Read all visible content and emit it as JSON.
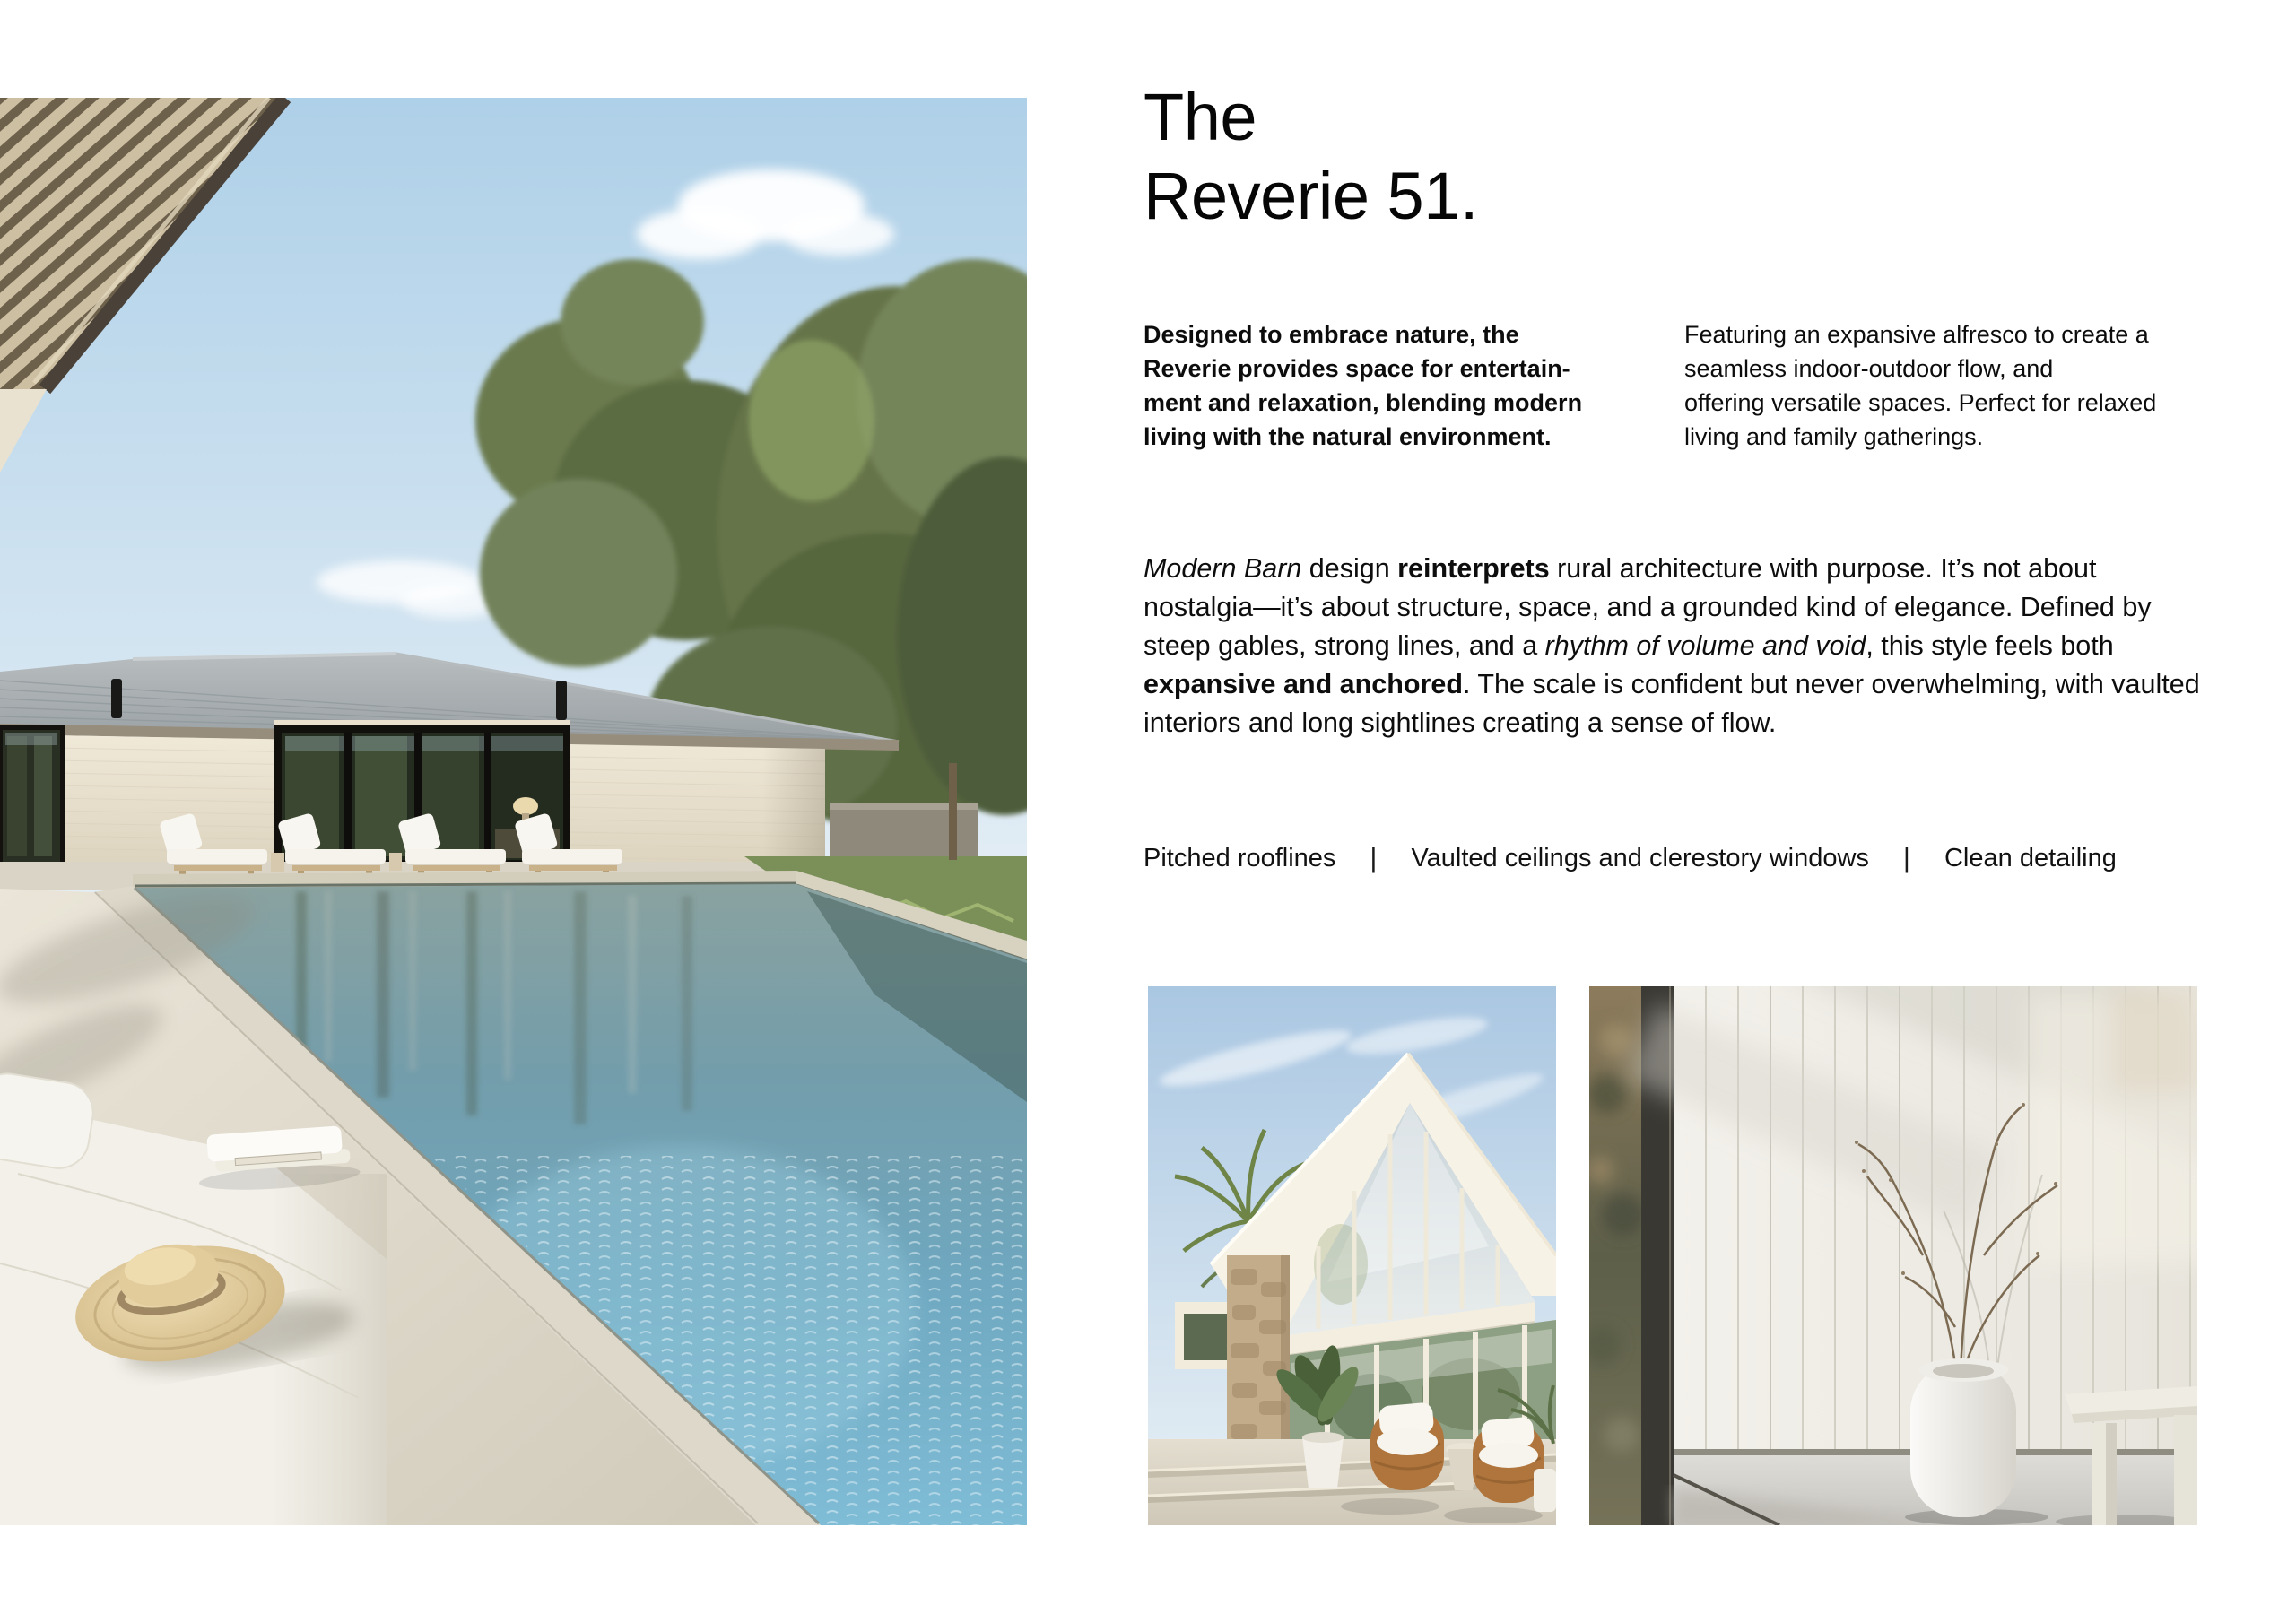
{
  "page": {
    "background": "#ffffff",
    "text_color": "#0a0a0a"
  },
  "title": {
    "line1": "The",
    "line2": "Reverie 51."
  },
  "intro": {
    "left": {
      "lines": [
        "Designed to embrace nature, the",
        "Reverie provides space for entertain-",
        "ment and relaxation, blending modern",
        "living with the natural environment."
      ]
    },
    "right": {
      "lines": [
        "Featuring an expansive alfresco to create a",
        "seamless indoor-outdoor flow, and",
        "offering versatile spaces. Perfect for relaxed",
        "living and family gatherings."
      ]
    }
  },
  "body_paragraph": {
    "lines": [
      {
        "seg0": "Modern Barn",
        "seg1": " design ",
        "seg2": "reinterprets",
        "seg3": " rural architecture with purpose. It’s not about"
      },
      {
        "seg0": "nostalgia—it’s about structure, space, and a grounded kind of elegance. Defined by"
      },
      {
        "seg0": "steep gables, strong lines, and a ",
        "seg1": "rhythm of volume and void",
        "seg2": ", this style feels both"
      },
      {
        "seg0": "expansive and anchored",
        "seg1": ". The scale is confident but never overwhelming, with vaulted"
      },
      {
        "seg0": "interiors and long sightlines creating a sense of flow."
      }
    ]
  },
  "features": {
    "divider": "|",
    "items": [
      "Pitched rooflines",
      "Vaulted ceilings and clerestory windows",
      "Clean detailing"
    ]
  }
}
